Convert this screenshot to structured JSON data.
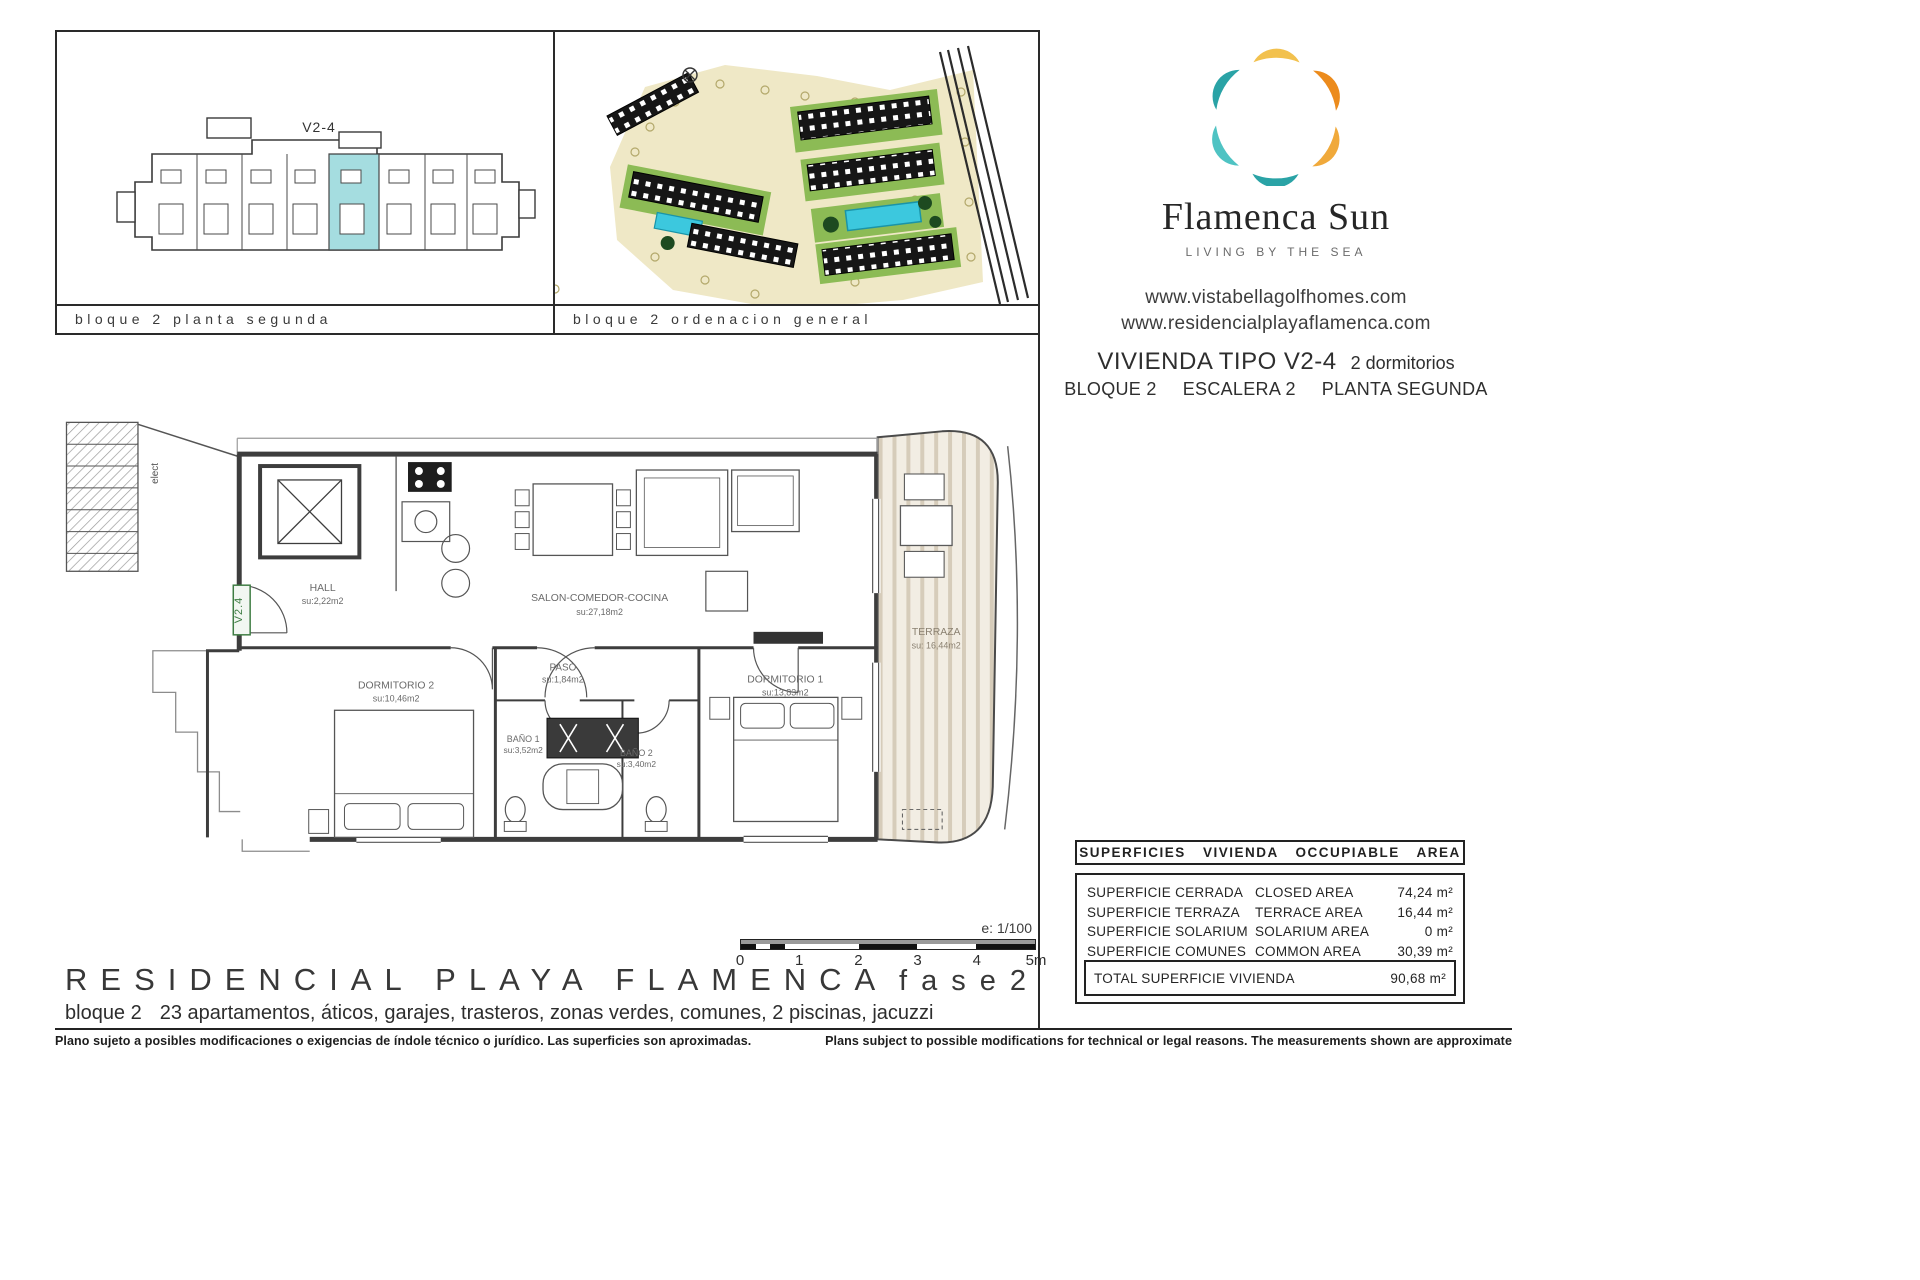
{
  "panels": {
    "panel1_caption": "bloque 2 planta segunda",
    "panel2_caption": "bloque 2 ordenacion general"
  },
  "brand": {
    "name": "Flamenca Sun",
    "tagline": "LIVING BY THE SEA",
    "url1": "www.vistabellagolfhomes.com",
    "url2": "www.residencialplayaflamenca.com"
  },
  "unit": {
    "title": "VIVIENDA TIPO V2-4",
    "bedrooms": "2 dormitorios",
    "bloque": "BLOQUE 2",
    "escalera": "ESCALERA 2",
    "planta": "PLANTA SEGUNDA",
    "tag": "V2-4",
    "entrance_tag": "V2.4"
  },
  "floorplan": {
    "rooms": [
      {
        "name": "HALL",
        "area": "su:2,22m2"
      },
      {
        "name": "SALON-COMEDOR-COCINA",
        "area": "su:27,18m2"
      },
      {
        "name": "PASO",
        "area": "su:1,84m2"
      },
      {
        "name": "DORMITORIO 2",
        "area": "su:10,46m2"
      },
      {
        "name": "DORMITORIO 1",
        "area": "su:13,83m2"
      },
      {
        "name": "BAÑO 1",
        "area": "su:3,52m2"
      },
      {
        "name": "BAÑO 2",
        "area": "su:3,40m2"
      },
      {
        "name": "TERRAZA",
        "area": "su: 16,44m2"
      }
    ],
    "elect_label": "elect",
    "scale_label": "e: 1/100",
    "scale_ticks": [
      "0",
      "1",
      "2",
      "3",
      "4",
      "5m"
    ]
  },
  "surfaces": {
    "header": "SUPERFICIES VIVIENDA OCCUPIABLE AREA",
    "rows": [
      {
        "es": "SUPERFICIE CERRADA",
        "en": "CLOSED AREA",
        "value": "74,24 m²"
      },
      {
        "es": "SUPERFICIE TERRAZA",
        "en": "TERRACE AREA",
        "value": "16,44 m²"
      },
      {
        "es": "SUPERFICIE SOLARIUM",
        "en": "SOLARIUM AREA",
        "value": "0 m²"
      },
      {
        "es": "SUPERFICIE COMUNES",
        "en": "COMMON AREA",
        "value": "30,39 m²"
      }
    ],
    "total_label": "TOTAL SUPERFICIE VIVIENDA",
    "total_value": "90,68 m²"
  },
  "footer": {
    "project": "RESIDENCIAL PLAYA FLAMENCA",
    "fase": "fase2",
    "desc_prefix": "bloque 2",
    "desc_rest": "23 apartamentos, áticos, garajes, trasteros, zonas verdes, comunes, 2 piscinas, jacuzzi",
    "disclaimer_es": "Plano sujeto a posibles modificaciones o exigencias de índole técnico o jurídico. Las superficies son aproximadas.",
    "disclaimer_en": "Plans subject to possible modifications for technical or legal reasons. The measurements shown are approximate"
  },
  "colors": {
    "ink": "#2b2b2b",
    "line": "#3d3d3d",
    "label_gray": "#6a6a6a",
    "logo_yellow": "#f2c14e",
    "logo_orange": "#ec8b1c",
    "logo_orange2": "#f0a93b",
    "logo_teal": "#2aa3a6",
    "logo_teal2": "#4fc3c3",
    "highlight_unit": "#a5dde0",
    "pool_blue": "#3cc8de",
    "site_green": "#8cbb55",
    "site_sand": "#efe8c6",
    "terrace_stripe": "#d6ccba",
    "tag_green": "#3f7d44"
  }
}
